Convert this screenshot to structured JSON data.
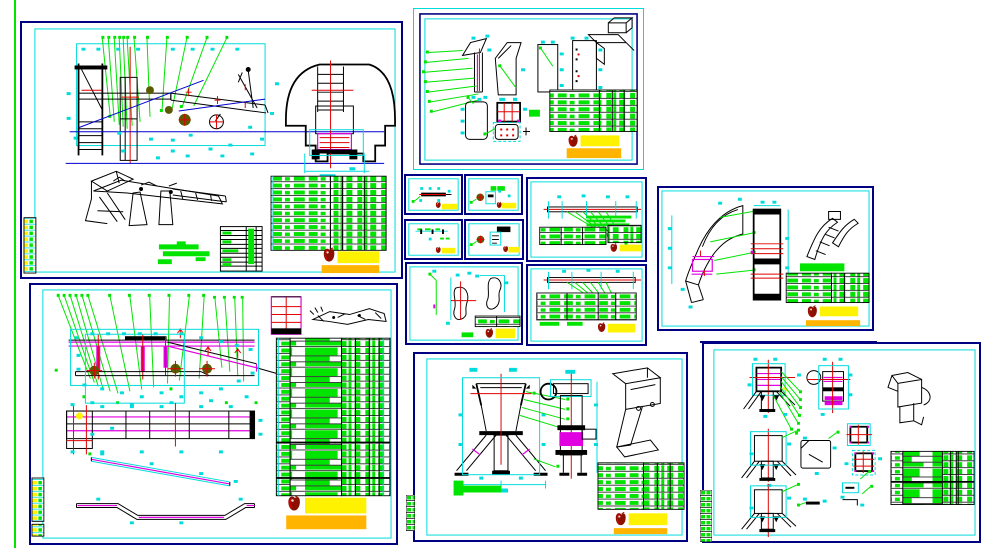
{
  "document": {
    "kind": "cad-multi-sheet-technical-drawing",
    "visible_text": "none-legible",
    "sheet_count": 12
  },
  "colors": {
    "paper": "#FFFFFF",
    "navy": "#000082",
    "cyan": "#00DCDC",
    "green": "#00E400",
    "blue": "#0000D2",
    "red": "#E00000",
    "magenta": "#E000E0",
    "yellow": "#FFF200",
    "orange": "#FFB400",
    "stamp_dark": "#8C1000",
    "olive": "#5A5A00"
  },
  "sheets": [
    {
      "id": "main-assembly"
    },
    {
      "id": "frame-assembly"
    },
    {
      "id": "panel-parts"
    },
    {
      "id": "detail-a"
    },
    {
      "id": "detail-b"
    },
    {
      "id": "detail-c"
    },
    {
      "id": "detail-d"
    },
    {
      "id": "shaft-upper"
    },
    {
      "id": "shaft-lower"
    },
    {
      "id": "bracket-parts"
    },
    {
      "id": "curved-chute"
    },
    {
      "id": "hopper-assembly"
    },
    {
      "id": "hopper-parts"
    }
  ],
  "icons": {
    "stamp": "red-seal-stamp-icon"
  }
}
